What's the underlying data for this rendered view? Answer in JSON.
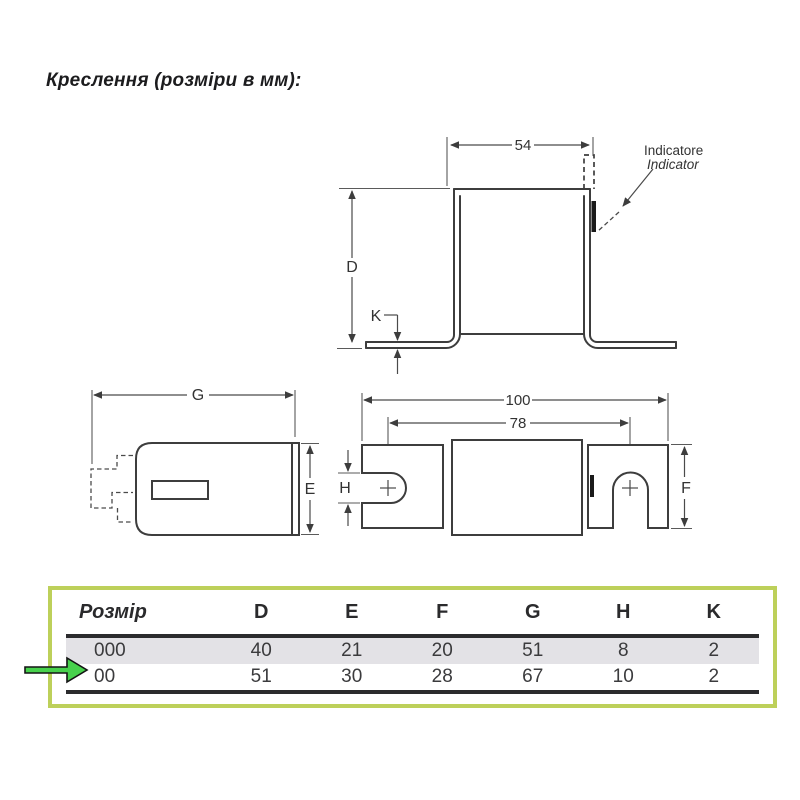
{
  "title": "Креслення (розміри в мм):",
  "drawing": {
    "front_view": {
      "dims": {
        "top_width": "54",
        "height": "D",
        "foot_thickness": "K"
      },
      "indicator_label": {
        "line1": "Indicatore",
        "line2": "Indicator"
      }
    },
    "side_view": {
      "dims": {
        "length": "G",
        "height": "E"
      }
    },
    "top_view": {
      "dims": {
        "overall_length": "100",
        "centers_distance": "78",
        "slot_width": "H",
        "blade_width": "F"
      }
    }
  },
  "table": {
    "size_column_header": "Розмір",
    "dim_columns": [
      "D",
      "E",
      "F",
      "G",
      "H",
      "K"
    ],
    "rows": [
      {
        "size": "000",
        "values": [
          "40",
          "21",
          "20",
          "51",
          "8",
          "2"
        ]
      },
      {
        "size": "00",
        "values": [
          "51",
          "30",
          "28",
          "67",
          "10",
          "2"
        ]
      }
    ],
    "pointed_row": "00"
  },
  "colors": {
    "highlight_box_border": "#bdd05a",
    "pointer_arrow_fill": "#47d14c",
    "shaded_row_bg": "#e3e2e6",
    "table_rule": "#2b2b2d",
    "drawing_line": "#3d3d3d"
  }
}
